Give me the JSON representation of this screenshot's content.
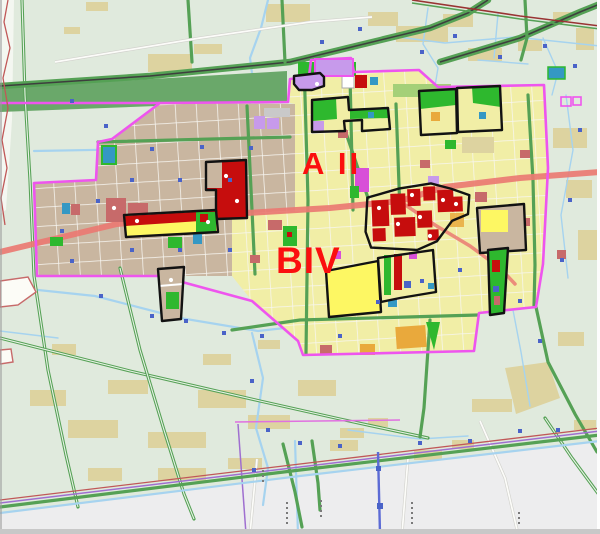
{
  "map": {
    "title": "urban land-use zoning map",
    "district_labels": [
      {
        "id": "a-ii",
        "text": "A II"
      },
      {
        "id": "b-iv",
        "text": "BIV"
      }
    ],
    "palette": {
      "bg_rural": "#e0eadd",
      "bg_outside": "#ededee",
      "patch_tan": "#ddd3a0",
      "urban_tan": "#c9b6a0",
      "urban_yellow": "#f1eea6",
      "greenbelt": "#6aa86a",
      "block_yellow_bright": "#fdf763",
      "block_red": "#c60d0d",
      "block_red_dull": "#c76a6a",
      "block_green": "#2eb82e",
      "block_green_light": "#a4d078",
      "block_orange": "#e9a93c",
      "block_violet": "#c79aeb",
      "block_magenta": "#d84fd8",
      "block_teal": "#3498c4",
      "water": "#a6d3ef",
      "road_green": "#55a155",
      "road_red": "#ea7a72",
      "boundary_magenta": "#ee55ee",
      "rail_red": "#993333",
      "line_purple": "#9f6fd0",
      "line_indigo": "#5c6bd5",
      "dot_blue": "#4a63c8",
      "shape_gray": "#c9c9c9",
      "label_red": "#fb0f0f",
      "outline_black": "#121212"
    }
  }
}
